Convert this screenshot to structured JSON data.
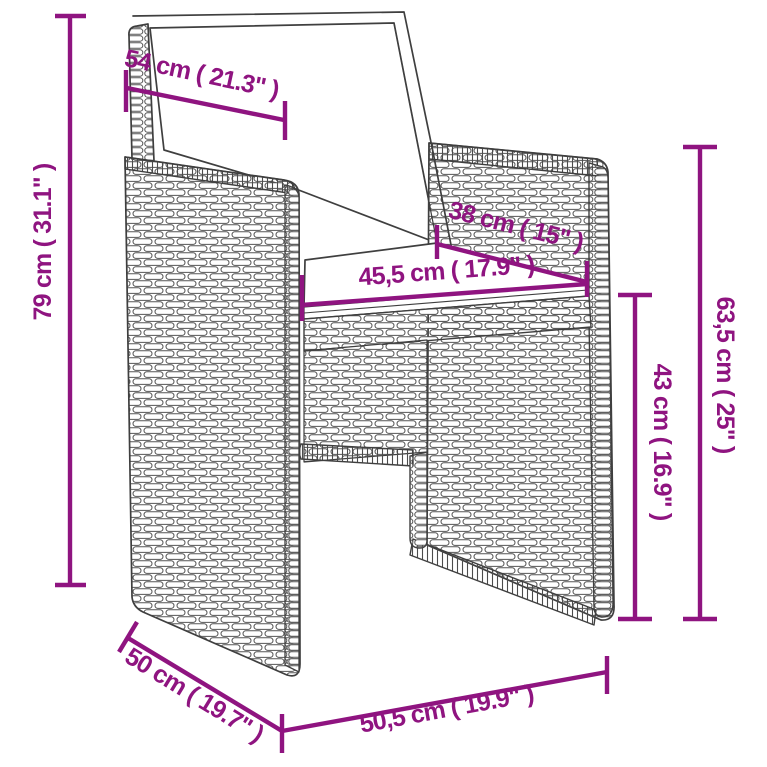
{
  "page": {
    "background": "#ffffff",
    "width": 767,
    "height": 767
  },
  "diagram": {
    "kind": "furniture-dimension-line-drawing",
    "subject": "poly rattan garden armchair with seat cushion and back cushion",
    "accent_color": "#8f1480",
    "line_color": "#3f3f3f"
  },
  "dimensions": {
    "back_width": {
      "label": "54 cm ( 21.3\" )",
      "cm": "54",
      "inch": "21.3"
    },
    "total_height": {
      "label": "79 cm ( 31.1\" )",
      "cm": "79",
      "inch": "31.1"
    },
    "seat_depth": {
      "label": "38 cm ( 15\" )",
      "cm": "38",
      "inch": "15"
    },
    "seat_width": {
      "label": "45,5 cm ( 17.9\" )",
      "cm": "45,5",
      "inch": "17.9"
    },
    "side_height": {
      "label": "63,5 cm ( 25\" )",
      "cm": "63,5",
      "inch": "25"
    },
    "seat_height": {
      "label": "43 cm ( 16.9\" )",
      "cm": "43",
      "inch": "16.9"
    },
    "base_depth": {
      "label": "50 cm ( 19.7\" )",
      "cm": "50",
      "inch": "19.7"
    },
    "base_width": {
      "label": "50,5 cm ( 19.9\" )",
      "cm": "50,5",
      "inch": "19.9"
    }
  }
}
